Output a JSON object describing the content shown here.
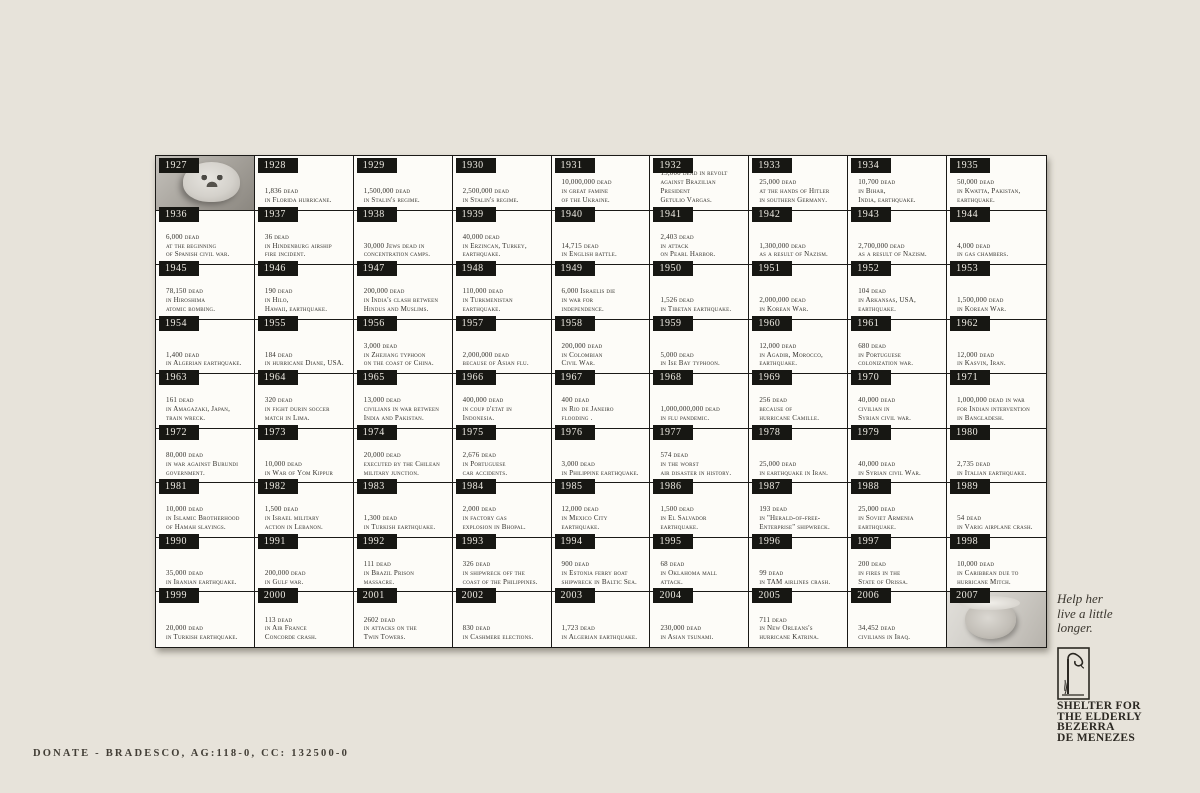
{
  "colors": {
    "background": "#e7e3da",
    "cell_bg": "#fdfcf8",
    "year_tab_bg": "#171713",
    "text": "#32302b"
  },
  "footer": {
    "donate_line": "DONATE - BRADESCO, AG:118-0, CC: 132500-0"
  },
  "sidebar": {
    "tagline_lines": [
      "Help her",
      "live a little",
      "longer."
    ],
    "org_name_lines": [
      "SHELTER FOR",
      "THE ELDERLY",
      "BEZERRA",
      "DE MENEZES"
    ],
    "logo_icon": "wilted-flower-icon"
  },
  "timeline": {
    "cells": [
      {
        "year": "1927",
        "photo": "baby-photo"
      },
      {
        "year": "1928",
        "lines": [
          "1,836 dead",
          "in Florida hurricane."
        ]
      },
      {
        "year": "1929",
        "lines": [
          "1,500,000 dead",
          "in Stalin's regime."
        ]
      },
      {
        "year": "1930",
        "lines": [
          "2,500,000 dead",
          "in Stalin's regime."
        ]
      },
      {
        "year": "1931",
        "lines": [
          "10,000,000 dead",
          "in great famine",
          "of the Ukraine."
        ]
      },
      {
        "year": "1932",
        "lines": [
          "15,000 dead in revolt",
          "against Brazilian President",
          "Getulio Vargas."
        ]
      },
      {
        "year": "1933",
        "lines": [
          "25,000 dead",
          "at the hands of Hitler",
          "in southern Germany."
        ]
      },
      {
        "year": "1934",
        "lines": [
          "10,700 dead",
          "in Bihar,",
          "India, earthquake."
        ]
      },
      {
        "year": "1935",
        "lines": [
          "50,000 dead",
          "in Kwatta, Pakistan,",
          "earthquake."
        ]
      },
      {
        "year": "1936",
        "lines": [
          "6,000 dead",
          "at the beginning",
          "of Spanish civil war."
        ]
      },
      {
        "year": "1937",
        "lines": [
          "36 dead",
          "in Hindenburg airship",
          "fire incident."
        ]
      },
      {
        "year": "1938",
        "lines": [
          "30,000 Jews dead in",
          "concentration camps."
        ]
      },
      {
        "year": "1939",
        "lines": [
          "40,000 dead",
          "in Erzincan, Turkey,",
          "earthquake."
        ]
      },
      {
        "year": "1940",
        "lines": [
          "14,715 dead",
          "in English battle."
        ]
      },
      {
        "year": "1941",
        "lines": [
          "2,403 dead",
          "in attack",
          "on Pearl Harbor."
        ]
      },
      {
        "year": "1942",
        "lines": [
          "1,300,000 dead",
          "as a result of Nazism."
        ]
      },
      {
        "year": "1943",
        "lines": [
          "2,700,000 dead",
          "as a result of Nazism."
        ]
      },
      {
        "year": "1944",
        "lines": [
          "4,000 dead",
          "in gas chambers."
        ]
      },
      {
        "year": "1945",
        "lines": [
          "78,150 dead",
          "in Hiroshima",
          "atomic bombing."
        ]
      },
      {
        "year": "1946",
        "lines": [
          "190 dead",
          "in Hilo,",
          "Hawaii, earthquake."
        ]
      },
      {
        "year": "1947",
        "lines": [
          "200,000 dead",
          "in India's clash between",
          "Hindus and Muslims."
        ]
      },
      {
        "year": "1948",
        "lines": [
          "110,000 dead",
          "in Turkmenistan",
          "earthquake."
        ]
      },
      {
        "year": "1949",
        "lines": [
          "6,000 Israelis die",
          "in war for",
          "independence."
        ]
      },
      {
        "year": "1950",
        "lines": [
          "1,526 dead",
          "in Tibetan earthquake."
        ]
      },
      {
        "year": "1951",
        "lines": [
          "2,000,000 dead",
          "in Korean War."
        ]
      },
      {
        "year": "1952",
        "lines": [
          "104 dead",
          "in Arkansas, USA,",
          "earthquake."
        ]
      },
      {
        "year": "1953",
        "lines": [
          "1,500,000 dead",
          "in Korean War."
        ]
      },
      {
        "year": "1954",
        "lines": [
          "1,400 dead",
          "in Algerian earthquake."
        ]
      },
      {
        "year": "1955",
        "lines": [
          "184 dead",
          "in hurricane Diane, USA."
        ]
      },
      {
        "year": "1956",
        "lines": [
          "3,000 dead",
          "in Zhejiang typhoon",
          "on the coast of China."
        ]
      },
      {
        "year": "1957",
        "lines": [
          "2,000,000 dead",
          "because of Asian flu."
        ]
      },
      {
        "year": "1958",
        "lines": [
          "200,000 dead",
          "in Colombian",
          "Civil War."
        ]
      },
      {
        "year": "1959",
        "lines": [
          "5,000 dead",
          "in Ise Bay typhoon."
        ]
      },
      {
        "year": "1960",
        "lines": [
          "12,000 dead",
          "in Agadir, Morocco,",
          "earthquake."
        ]
      },
      {
        "year": "1961",
        "lines": [
          "680 dead",
          "in Portuguese",
          "colonization war."
        ]
      },
      {
        "year": "1962",
        "lines": [
          "12,000 dead",
          "in Kasvin, Iran."
        ]
      },
      {
        "year": "1963",
        "lines": [
          "161 dead",
          "in Amagazaki, Japan,",
          "train wreck."
        ]
      },
      {
        "year": "1964",
        "lines": [
          "320 dead",
          "in fight durin soccer",
          "match in Lima."
        ]
      },
      {
        "year": "1965",
        "lines": [
          "13,000 dead",
          "civilians in war between",
          "India and Pakistan."
        ]
      },
      {
        "year": "1966",
        "lines": [
          "400,000 dead",
          "in coup d'etat in",
          "Indonesia."
        ]
      },
      {
        "year": "1967",
        "lines": [
          "400 dead",
          "in Rio de Janeiro",
          "flooding ."
        ]
      },
      {
        "year": "1968",
        "lines": [
          "1,000,000,000 dead",
          "in flu pandemic."
        ]
      },
      {
        "year": "1969",
        "lines": [
          "256 dead",
          "because of",
          "hurricane Camille."
        ]
      },
      {
        "year": "1970",
        "lines": [
          "40,000 dead",
          "civilian in",
          "Syrian civil war."
        ]
      },
      {
        "year": "1971",
        "lines": [
          "1,000,000 dead in war",
          "for Indian intervention",
          "in Bangladesh."
        ]
      },
      {
        "year": "1972",
        "lines": [
          "80,000 dead",
          "in war against Burundi",
          "government."
        ]
      },
      {
        "year": "1973",
        "lines": [
          "10,000 dead",
          "in War of Yom Kippur"
        ]
      },
      {
        "year": "1974",
        "lines": [
          "20,000 dead",
          "executed by the Chilean",
          "military junction."
        ]
      },
      {
        "year": "1975",
        "lines": [
          "2,676 dead",
          "in Portuguese",
          "car accidents."
        ]
      },
      {
        "year": "1976",
        "lines": [
          "3,000 dead",
          "in Philippine earthquake."
        ]
      },
      {
        "year": "1977",
        "lines": [
          "574 dead",
          "in the worst",
          "air disaster in history."
        ]
      },
      {
        "year": "1978",
        "lines": [
          "25,000 dead",
          "in earthquake in Iran."
        ]
      },
      {
        "year": "1979",
        "lines": [
          "40,000 dead",
          "in Syrian civil War."
        ]
      },
      {
        "year": "1980",
        "lines": [
          "2,735 dead",
          "in Italian earthquake."
        ]
      },
      {
        "year": "1981",
        "lines": [
          "10,000 dead",
          "in Islamic Brotherhood",
          "of Hamah slayings."
        ]
      },
      {
        "year": "1982",
        "lines": [
          "1,500 dead",
          "in Israel military",
          "action in Lebanon."
        ]
      },
      {
        "year": "1983",
        "lines": [
          "1,300 dead",
          "in Turkish earthquake."
        ]
      },
      {
        "year": "1984",
        "lines": [
          "2,000 dead",
          "in factory gas",
          "explosion in Bhopal."
        ]
      },
      {
        "year": "1985",
        "lines": [
          "12,000 dead",
          "in Mexico City",
          "earthquake."
        ]
      },
      {
        "year": "1986",
        "lines": [
          "1,500 dead",
          "in El Salvador",
          "earthquake."
        ]
      },
      {
        "year": "1987",
        "lines": [
          "193 dead",
          "in \"Herald-of-free-",
          "Enterprise\" shipwreck."
        ]
      },
      {
        "year": "1988",
        "lines": [
          "25,000 dead",
          "in Soviet Armenia",
          "earthquake."
        ]
      },
      {
        "year": "1989",
        "lines": [
          "54 dead",
          "in Varig airplane crash."
        ]
      },
      {
        "year": "1990",
        "lines": [
          "35,000 dead",
          "in Iranian earthquake."
        ]
      },
      {
        "year": "1991",
        "lines": [
          "200,000 dead",
          "in Gulf war."
        ]
      },
      {
        "year": "1992",
        "lines": [
          "111 dead",
          "in Brazil Prison",
          "massacre."
        ]
      },
      {
        "year": "1993",
        "lines": [
          "326 dead",
          "in shipwreck off the",
          "coast of the Philippines."
        ]
      },
      {
        "year": "1994",
        "lines": [
          "900 dead",
          "in Estonia ferry boat",
          "shipwreck in Baltic Sea."
        ]
      },
      {
        "year": "1995",
        "lines": [
          "68 dead",
          "in Oklahoma mall",
          "attack."
        ]
      },
      {
        "year": "1996",
        "lines": [
          "99 dead",
          "in TAM airlines crash."
        ]
      },
      {
        "year": "1997",
        "lines": [
          "200 dead",
          "in fires in the",
          "State of Orissa."
        ]
      },
      {
        "year": "1998",
        "lines": [
          "10,000 dead",
          "in Caribbean due to",
          "hurricane Mitch."
        ]
      },
      {
        "year": "1999",
        "lines": [
          "20,000 dead",
          "in Turkish earthquake."
        ]
      },
      {
        "year": "2000",
        "lines": [
          "113 dead",
          "in Air France",
          "Concorde crash."
        ]
      },
      {
        "year": "2001",
        "lines": [
          "2602 dead",
          "in attacks on the",
          "Twin Towers."
        ]
      },
      {
        "year": "2002",
        "lines": [
          "830 dead",
          "in Cashmere elections."
        ]
      },
      {
        "year": "2003",
        "lines": [
          "1,723 dead",
          "in Algerian earthquake."
        ]
      },
      {
        "year": "2004",
        "lines": [
          "230,000 dead",
          "in Asian tsunami."
        ]
      },
      {
        "year": "2005",
        "lines": [
          "711 dead",
          "in New Orleans's",
          "hurricane Katrina."
        ]
      },
      {
        "year": "2006",
        "lines": [
          "34,452 dead",
          "civilians in Iraq."
        ]
      },
      {
        "year": "2007",
        "photo": "elderly-woman-photo"
      }
    ]
  }
}
